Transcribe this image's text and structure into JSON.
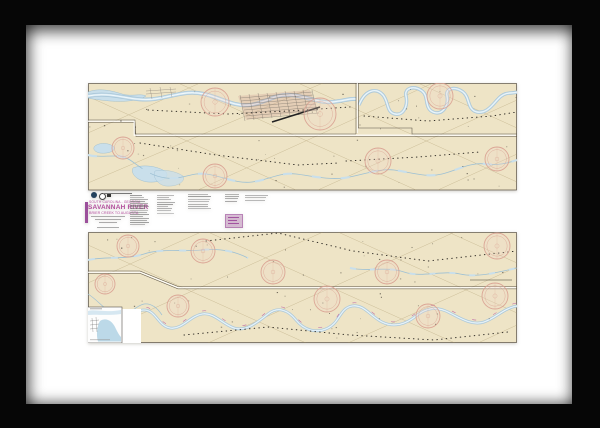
{
  "scene": {
    "kind": "framed nautical chart print",
    "frame_color": "#060606",
    "mat_color": "#ffffff"
  },
  "chart": {
    "paper_color": "#eee4c6",
    "border_color": "#595144",
    "water_fill": "#c9dfeb",
    "water_edge": "#93b7cc",
    "channel_white": "#f3fafd",
    "graticule_color": "#a08c5e",
    "rose_ring": "#d9a091",
    "rose_fill": "#f0d3c8",
    "magenta": "#b44f9e",
    "ink": "#3f3a31",
    "title_block": {
      "region": "SOUTH CAROLINA - GEORGIA",
      "title": "SAVANNAH RIVER",
      "subtitle": "BRIER CREEK TO AUGUSTA"
    },
    "compass_roses": [
      {
        "x": 127,
        "y": 19,
        "r": 14
      },
      {
        "x": 232,
        "y": 31,
        "r": 16
      },
      {
        "x": 352,
        "y": 13,
        "r": 13
      },
      {
        "x": 35,
        "y": 65,
        "r": 11
      },
      {
        "x": 127,
        "y": 93,
        "r": 12
      },
      {
        "x": 290,
        "y": 78,
        "r": 13
      },
      {
        "x": 409,
        "y": 76,
        "r": 12
      },
      {
        "x": 40,
        "y": 163,
        "r": 11
      },
      {
        "x": 115,
        "y": 168,
        "r": 12
      },
      {
        "x": 185,
        "y": 189,
        "r": 12
      },
      {
        "x": 299,
        "y": 189,
        "r": 12
      },
      {
        "x": 409,
        "y": 163,
        "r": 13
      },
      {
        "x": 17,
        "y": 201,
        "r": 10
      },
      {
        "x": 90,
        "y": 223,
        "r": 11
      },
      {
        "x": 239,
        "y": 216,
        "r": 13
      },
      {
        "x": 340,
        "y": 233,
        "r": 12
      },
      {
        "x": 407,
        "y": 213,
        "r": 13
      }
    ]
  }
}
